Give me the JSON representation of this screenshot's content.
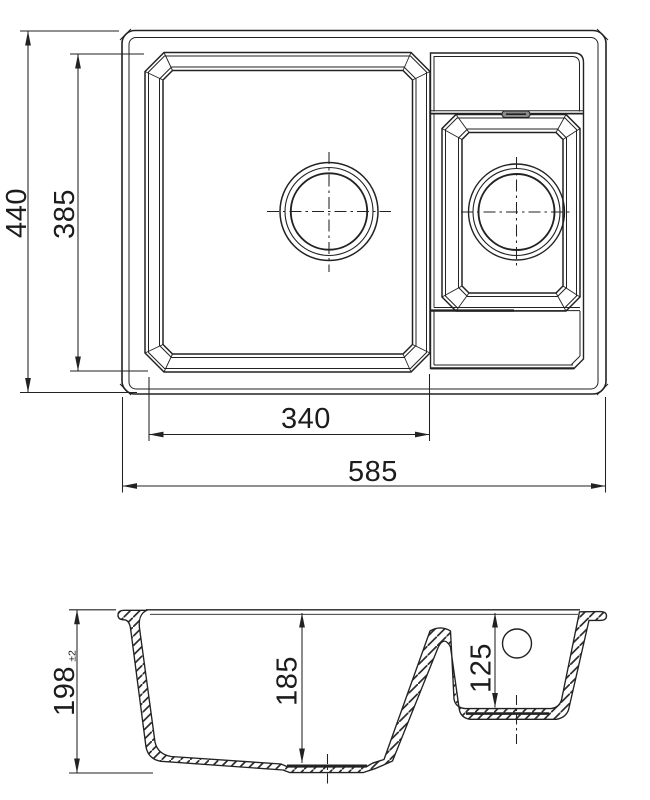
{
  "drawing": {
    "background": "#ffffff",
    "line_color": "#222222",
    "views": {
      "plan": {
        "name": "top-view of sink with main bowl and half bowl"
      },
      "section": {
        "name": "cross-section of sink bowls"
      }
    },
    "dimensions": {
      "overall_depth": "440",
      "inner_depth": "385",
      "main_bowl_width": "340",
      "overall_width": "585",
      "overall_height": "198",
      "overall_height_tolerance": "±2",
      "main_bowl_depth": "185",
      "half_bowl_depth": "125"
    }
  }
}
